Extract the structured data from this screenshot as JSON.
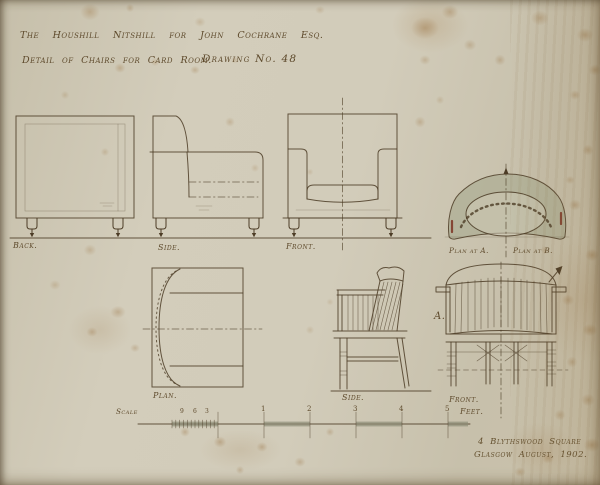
{
  "header": {
    "project_line": "The Houshill Nitshill for John Cochrane Esq.",
    "subject_line": "Detail of Chairs for Card Room.",
    "drawing_number": "Drawing No. 48"
  },
  "easy_chair": {
    "back_label": "Back.",
    "side_label": "Side.",
    "front_label": "Front.",
    "plan_label": "Plan.",
    "plan_at_a_label": "Plan at A.",
    "plan_at_b_label": "Plan at B."
  },
  "spindle_chair": {
    "side_label": "Side.",
    "front_label": "Front.",
    "section_marker": "A."
  },
  "scale_bar": {
    "scale_label": "Scale",
    "inch_labels": [
      "9",
      "6",
      "3"
    ],
    "foot_labels": [
      "1",
      "2",
      "3",
      "4",
      "5"
    ],
    "unit_label": "Feet."
  },
  "signature": {
    "address_line": "4 Blythswood Square",
    "place_date_line": "Glasgow August, 1902."
  },
  "colors": {
    "ink": "#4c3c26",
    "paper": "#cfc9b6",
    "wash": "#b2b29a",
    "stain": "#9a7440"
  }
}
